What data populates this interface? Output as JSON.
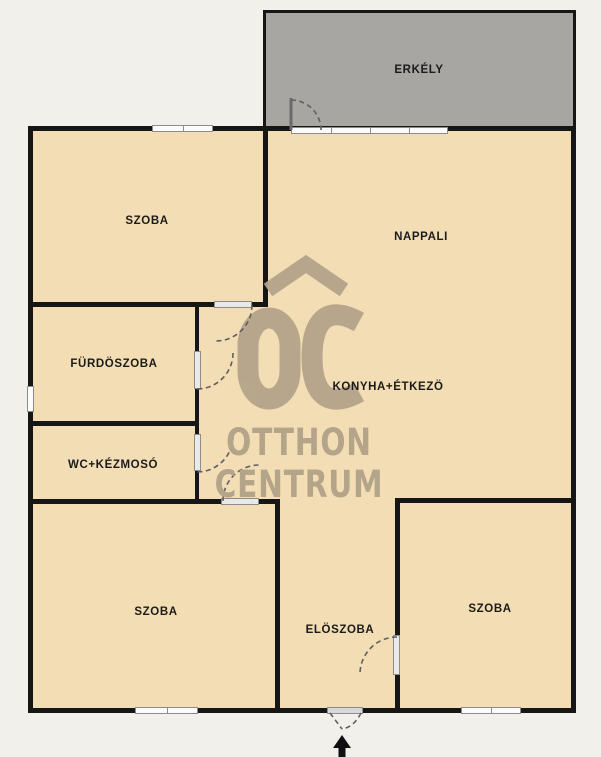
{
  "title": "Otthon Centrum floor plan",
  "rooms": {
    "erkely": {
      "label": "ERKÉLY"
    },
    "szoba_top_left": {
      "label": "SZOBA"
    },
    "nappali": {
      "label": "NAPPALI"
    },
    "furdoszoba": {
      "label": "FÜRDÖSZOBA"
    },
    "wc_kezmoso": {
      "label": "WC+KÉZMOSÓ"
    },
    "konyha_etkezo": {
      "label": "KONYHA+ÉTKEZÖ"
    },
    "szoba_bottom_left": {
      "label": "SZOBA"
    },
    "eloszoba": {
      "label": "ELÖSZOBA"
    },
    "szoba_bottom_right": {
      "label": "SZOBA"
    }
  },
  "watermark": {
    "monogram": "OC",
    "line1": "OTTHON",
    "line2": "CENTRUM"
  },
  "colors": {
    "background": "#f2f0eb",
    "room_fill": "#f3ddb4",
    "balcony_fill": "#a7a6a2",
    "wall": "#161616",
    "watermark": "#b4a489",
    "label": "#1b1b1b"
  }
}
